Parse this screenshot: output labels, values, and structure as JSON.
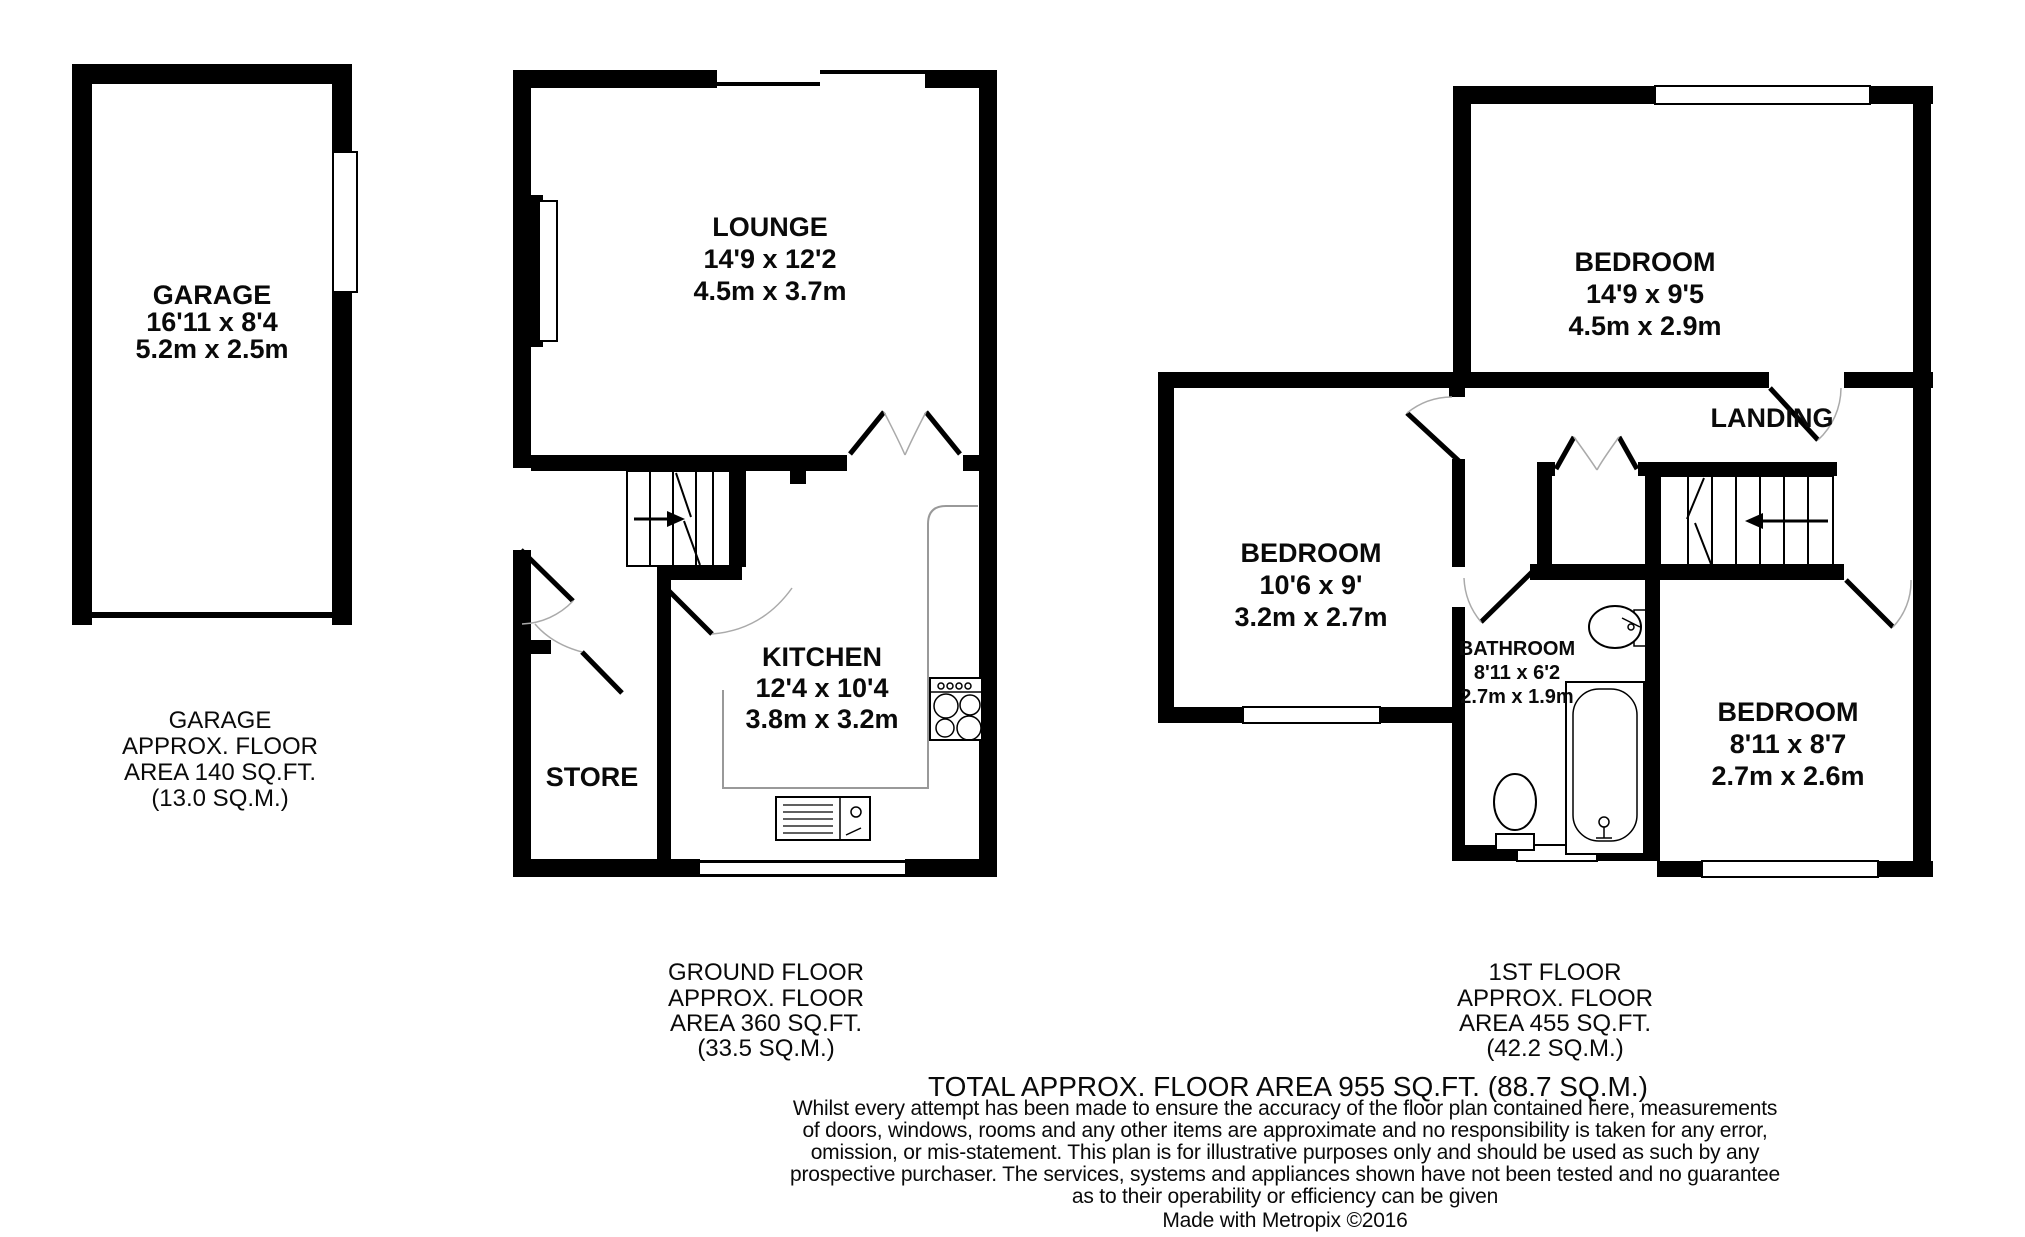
{
  "garage": {
    "room": {
      "name": "GARAGE",
      "imperial": "16'11 x 8'4",
      "metric": "5.2m x 2.5m"
    },
    "area_text": {
      "l1": "GARAGE",
      "l2": "APPROX. FLOOR",
      "l3": "AREA 140 SQ.FT.",
      "l4": "(13.0 SQ.M.)"
    }
  },
  "ground_floor": {
    "rooms": {
      "lounge": {
        "name": "LOUNGE",
        "imperial": "14'9 x 12'2",
        "metric": "4.5m x 3.7m"
      },
      "kitchen": {
        "name": "KITCHEN",
        "imperial": "12'4 x 10'4",
        "metric": "3.8m x 3.2m"
      },
      "store": {
        "name": "STORE"
      }
    },
    "area_text": {
      "l1": "GROUND FLOOR",
      "l2": "APPROX. FLOOR",
      "l3": "AREA 360 SQ.FT.",
      "l4": "(33.5 SQ.M.)"
    }
  },
  "first_floor": {
    "rooms": {
      "bedroom1": {
        "name": "BEDROOM",
        "imperial": "14'9 x 9'5",
        "metric": "4.5m x 2.9m"
      },
      "bedroom2": {
        "name": "BEDROOM",
        "imperial": "10'6 x 9'",
        "metric": "3.2m x 2.7m"
      },
      "bedroom3": {
        "name": "BEDROOM",
        "imperial": "8'11 x 8'7",
        "metric": "2.7m x 2.6m"
      },
      "bathroom": {
        "name": "BATHROOM",
        "imperial": "8'11 x 6'2",
        "metric": "2.7m x 1.9m"
      },
      "landing": {
        "name": "LANDING"
      }
    },
    "area_text": {
      "l1": "1ST FLOOR",
      "l2": "APPROX. FLOOR",
      "l3": "AREA 455 SQ.FT.",
      "l4": "(42.2 SQ.M.)"
    }
  },
  "footer": {
    "total": "TOTAL APPROX. FLOOR AREA 955 SQ.FT. (88.7 SQ.M.)",
    "disclaimer": [
      "Whilst every attempt has been made to ensure the accuracy of the floor plan contained here, measurements",
      "of doors, windows, rooms and any other items are approximate and no responsibility is taken for any error,",
      "omission, or mis-statement. This plan is for illustrative purposes only and should be used as such by any",
      "prospective purchaser. The services, systems and appliances shown have not been tested and no guarantee",
      "as to their operability or efficiency can be given"
    ],
    "credit": "Made with Metropix ©2016"
  },
  "colors": {
    "wall": "#000000",
    "background": "#ffffff",
    "counter": "#999999",
    "door_swing": "#aaaaaa"
  }
}
